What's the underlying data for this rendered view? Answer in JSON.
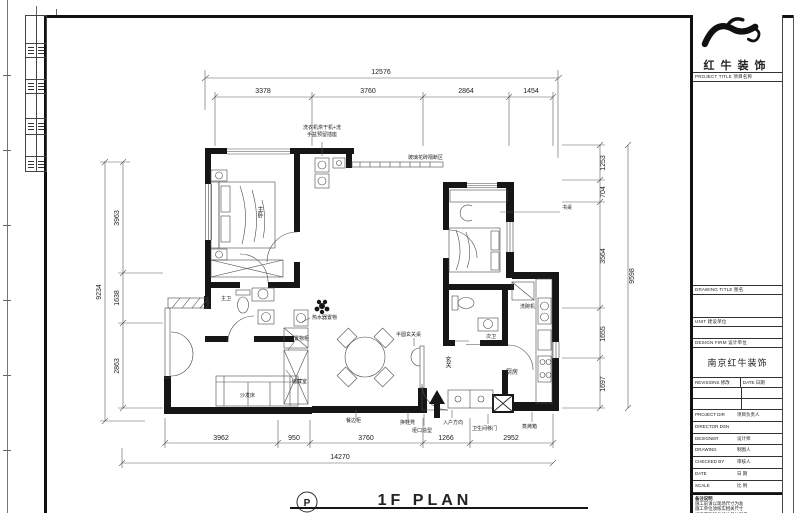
{
  "title_block": {
    "logo_text": "红牛装饰",
    "project_title_label": "PROJECT TITLE 项目名称",
    "drawing_title_label": "DRAWING TITLE 图名",
    "unit_label": "UNIT 建设单位",
    "design_firm_label": "DESIGN FIRM 设计单位",
    "design_firm_name": "南京红牛装饰",
    "revisions_label": "REVISIONS 修改",
    "date_col_label": "DATE 日期",
    "rows": [
      {
        "en": "PROJECT DIR",
        "zh": "项目负责人"
      },
      {
        "en": "DIRECTOR DSN",
        "zh": ""
      },
      {
        "en": "DESIGNER",
        "zh": "设计师"
      },
      {
        "en": "DRAWING",
        "zh": "制图人"
      },
      {
        "en": "CHECKED BY",
        "zh": "审核人"
      },
      {
        "en": "DATE",
        "zh": "日 期"
      },
      {
        "en": "SCALE",
        "zh": "比 例"
      }
    ],
    "notes_title": "备注说明",
    "notes": [
      "施工前请以现场尺寸为准",
      "施工单位须核实相关尺寸",
      "如有不明请与设计单位联系",
      "This drawing is copyright"
    ],
    "footer_bar": "南京红牛装饰设计工程有限公司"
  },
  "plan": {
    "sheet_symbol": "P",
    "sheet_title": "1F PLAN",
    "dims": {
      "top_overall": "12576",
      "top_segments": [
        "3378",
        "3760",
        "2864",
        "1454"
      ],
      "left_overall": "9234",
      "left_segments": [
        "3963",
        "1638",
        "2863"
      ],
      "right_overall": "9598",
      "right_segments": [
        "1253",
        "704",
        "3564",
        "1655",
        "1697"
      ],
      "bottom_overall": "14270",
      "bottom_segments": [
        "3962",
        "950",
        "3760",
        "1266",
        "2952"
      ]
    },
    "rooms": {
      "master_bedroom": "主卧",
      "master_bath": "主卫",
      "second_bath": "次卫",
      "kitchen": "厨房",
      "entry": "玄关",
      "sofa": "沙发床"
    },
    "annotations": {
      "laundry_line1": "洗衣机烘干机+洗",
      "laundry_line2": "手盆预留插座",
      "partition": "玻璃花砖隔断区",
      "desk": "书桌",
      "water_heater": "热水器置物",
      "upper_cabinet": "置物柜",
      "storage": "储藏室",
      "console": "半圆玄关桌",
      "dishwasher": "洗碗机",
      "sideboard": "餐边柜",
      "shoe_bench": "换鞋凳",
      "doorway": "垭口造型",
      "entry_dir": "入户方向",
      "bath_door": "卫生间移门",
      "steam_oven": "蒸烤箱"
    }
  }
}
